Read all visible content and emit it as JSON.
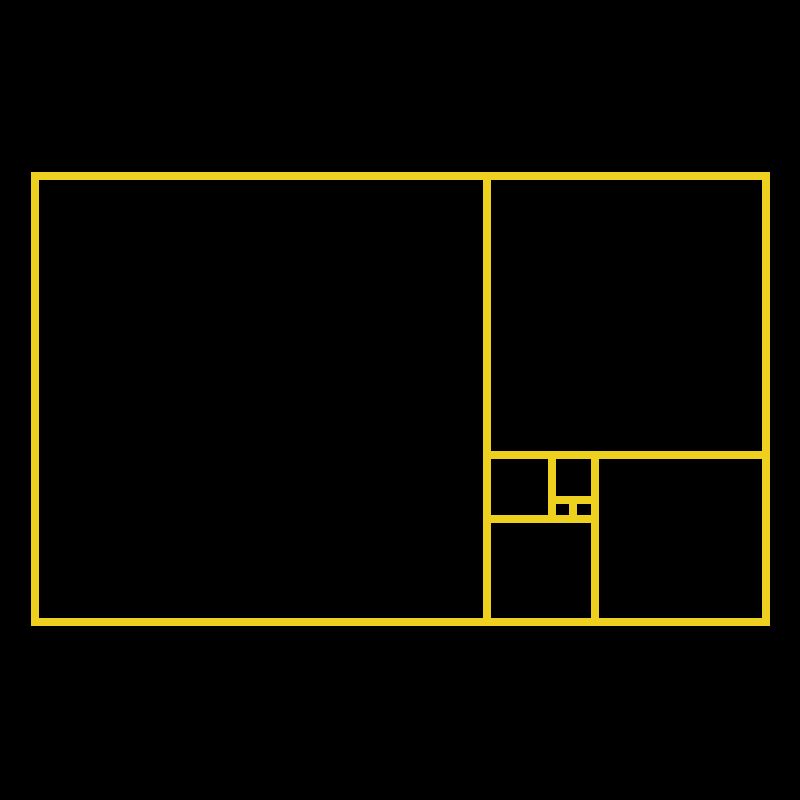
{
  "figure": {
    "name": "fibonacci-golden-rectangle-diagram",
    "background_color": "#000000",
    "line_color": "#EDD11E",
    "line_width": 8,
    "canvas": {
      "width": 800,
      "height": 800
    },
    "squares": [
      {
        "label": "square-fib-21",
        "fib": 21,
        "x": 35,
        "y": 176,
        "w": 452,
        "h": 446
      },
      {
        "label": "square-fib-13",
        "fib": 13,
        "x": 487,
        "y": 176,
        "w": 279,
        "h": 279
      },
      {
        "label": "square-fib-8",
        "fib": 8,
        "x": 595,
        "y": 455,
        "w": 171,
        "h": 167
      },
      {
        "label": "square-fib-5",
        "fib": 5,
        "x": 487,
        "y": 519,
        "w": 108,
        "h": 103
      },
      {
        "label": "square-fib-3",
        "fib": 3,
        "x": 487,
        "y": 455,
        "w": 65,
        "h": 64
      },
      {
        "label": "square-fib-2",
        "fib": 2,
        "x": 552,
        "y": 455,
        "w": 43,
        "h": 45
      },
      {
        "label": "square-fib-1-left",
        "fib": 1,
        "x": 552,
        "y": 500,
        "w": 21,
        "h": 19
      },
      {
        "label": "square-fib-1-right",
        "fib": 1,
        "x": 573,
        "y": 500,
        "w": 22,
        "h": 19
      }
    ]
  }
}
